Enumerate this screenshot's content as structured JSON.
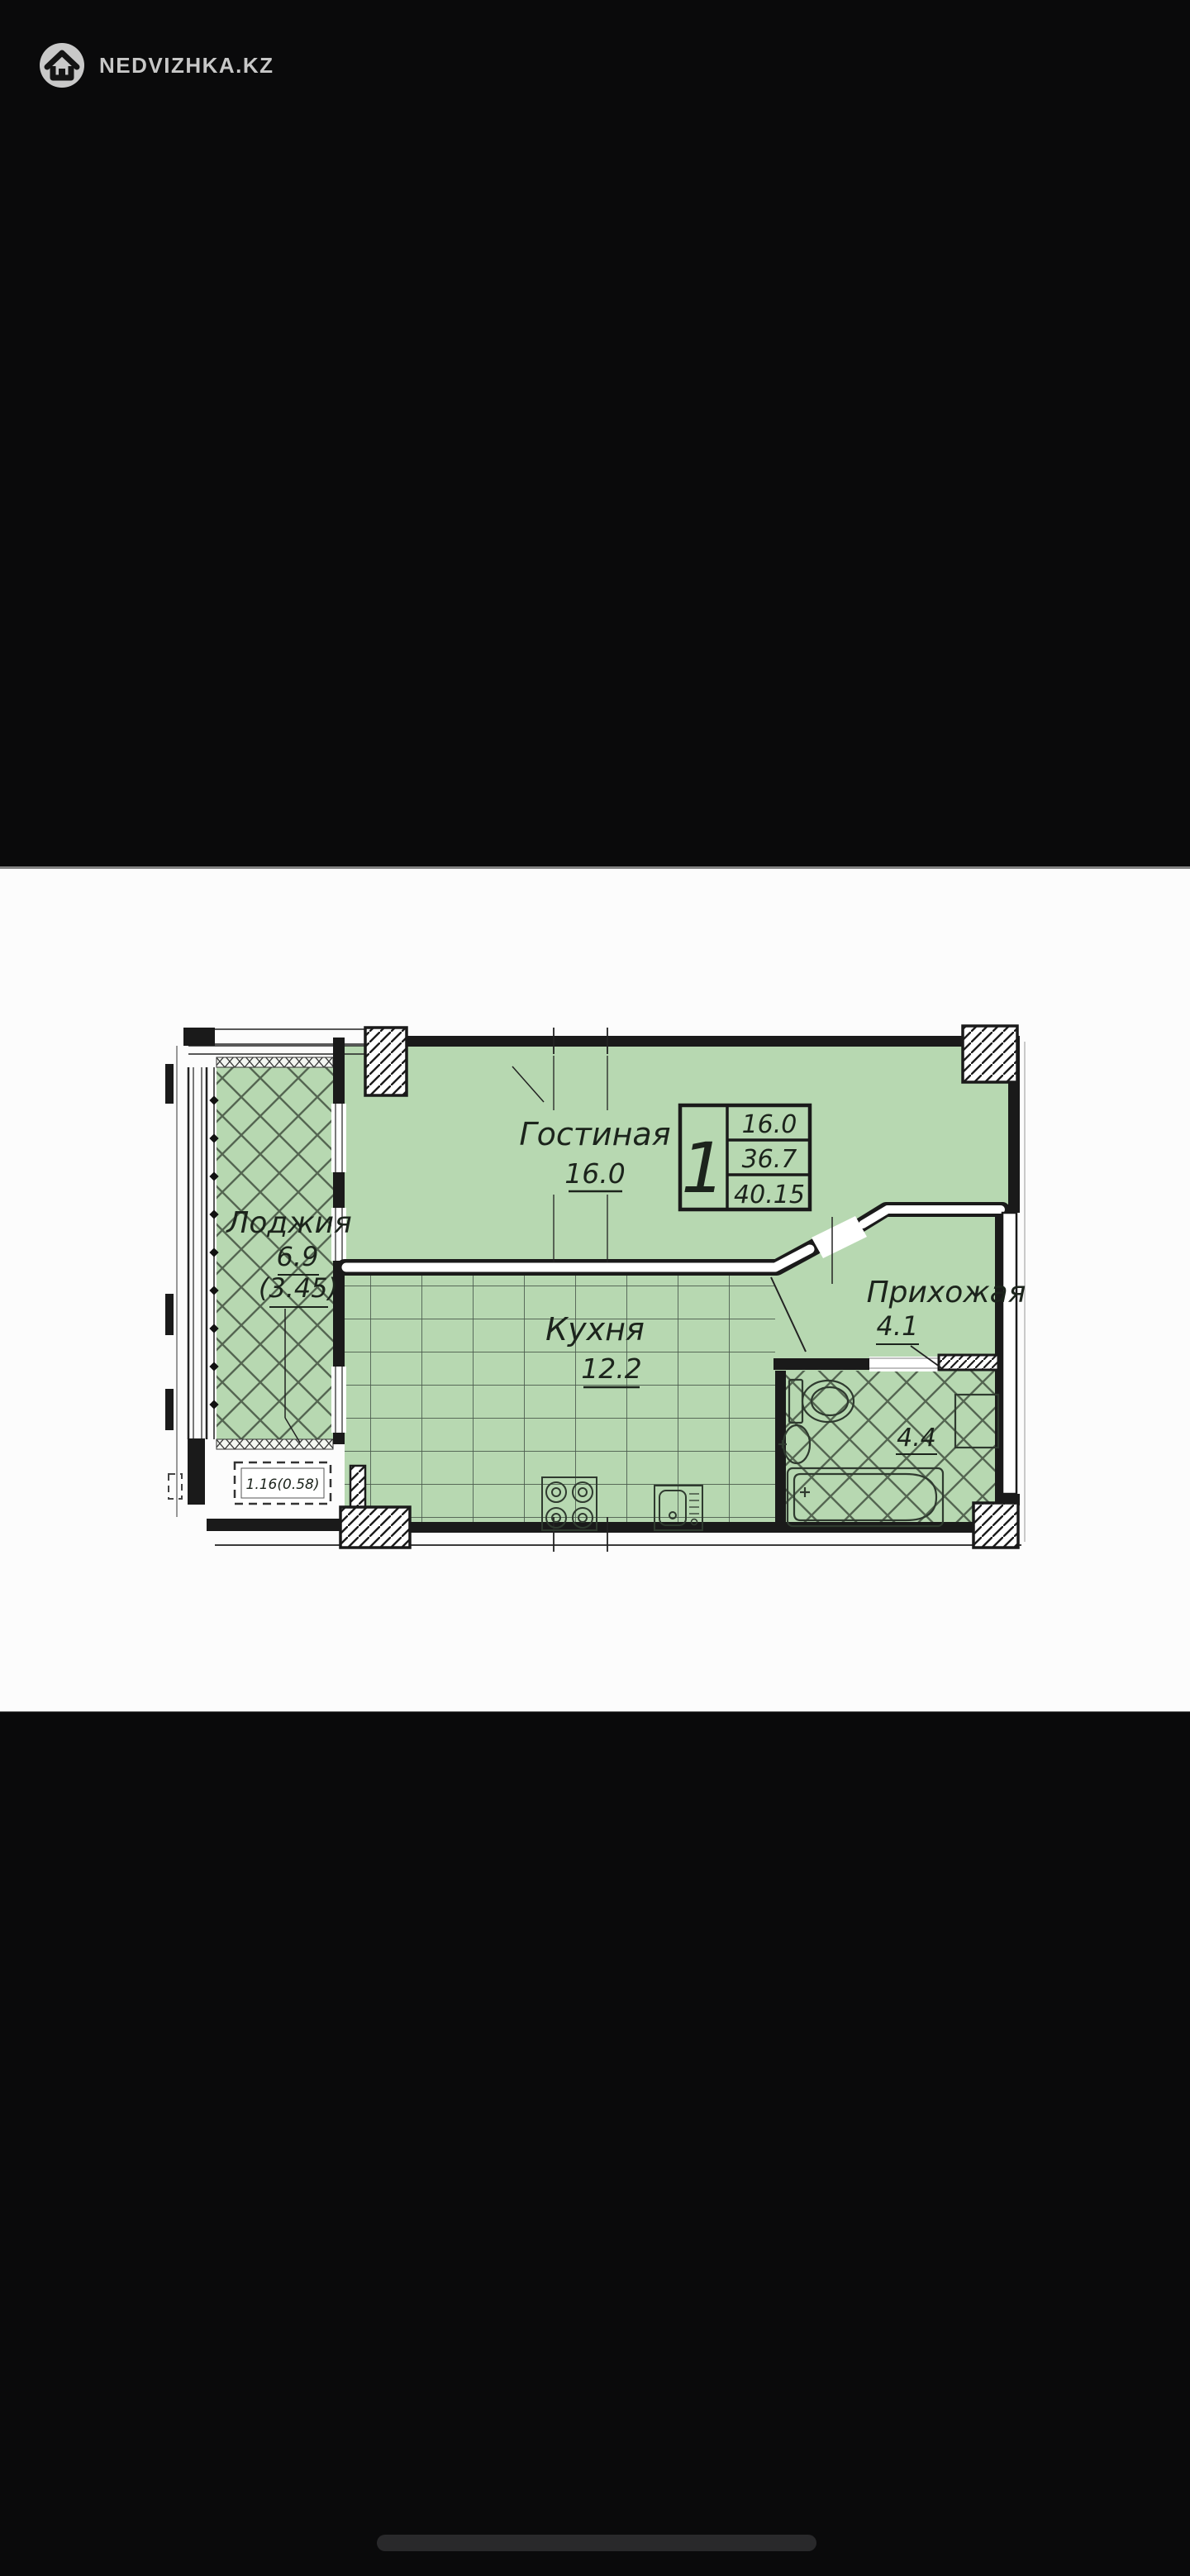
{
  "brand": {
    "name": "NEDVIZHKA.KZ"
  },
  "plan": {
    "rooms": {
      "living": {
        "label": "Гостиная",
        "area": "16.0"
      },
      "kitchen": {
        "label": "Кухня",
        "area": "12.2"
      },
      "hallway": {
        "label": "Прихожая",
        "area": "4.1"
      },
      "loggia": {
        "label": "Лоджия",
        "area": "6.9",
        "area_reduced": "(3.45)"
      },
      "bathroom": {
        "area": "4.4"
      },
      "balcony_niche": {
        "label": "1.16(0.58)"
      }
    },
    "info_table": {
      "rooms": "1",
      "rows": [
        "16.0",
        "36.7",
        "40.15"
      ]
    },
    "colors": {
      "room_fill": "#b7d8b1",
      "wall": "#1a1a1a"
    }
  }
}
